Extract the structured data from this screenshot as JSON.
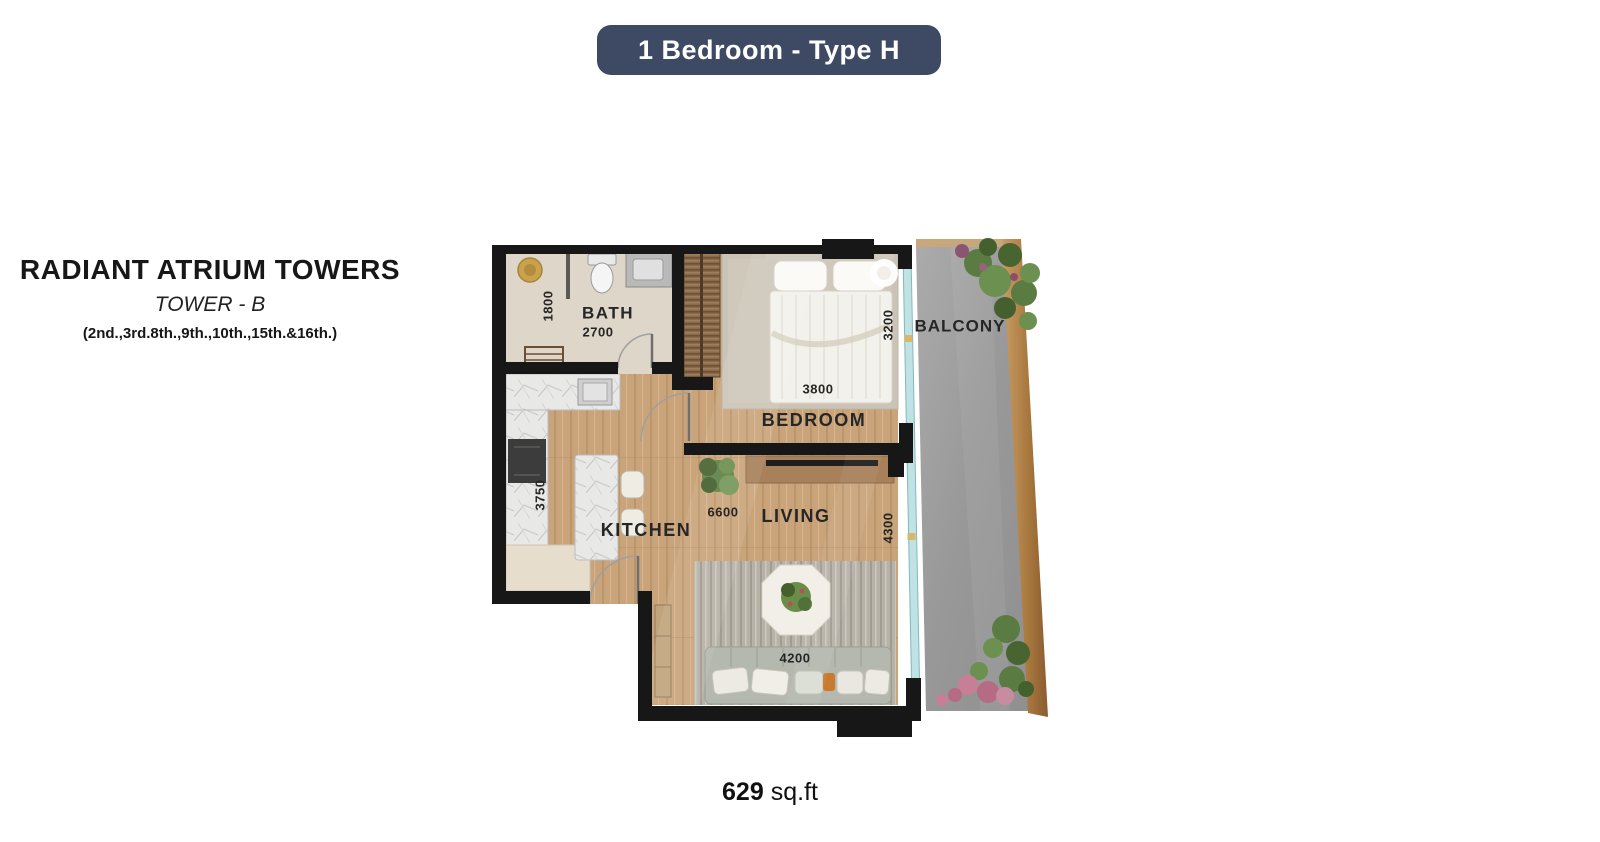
{
  "badge": {
    "label": "1 Bedroom - Type H"
  },
  "project": {
    "title": "RADIANT ATRIUM TOWERS",
    "tower": "TOWER - B",
    "floors": "(2nd.,3rd.8th.,9th.,10th.,15th.&16th.)"
  },
  "plan": {
    "bath": {
      "label": "BATH",
      "width": "2700",
      "depth": "1800"
    },
    "bedroom": {
      "label": "BEDROOM",
      "width": "3800",
      "depth": "3200"
    },
    "kitchen": {
      "label": "KITCHEN",
      "depth": "3750"
    },
    "living": {
      "label": "LIVING",
      "width": "6600",
      "depth": "4300",
      "sofa_width": "4200"
    },
    "balcony": {
      "label": "BALCONY"
    }
  },
  "area": {
    "value": "629",
    "unit": "sq.ft"
  },
  "colors": {
    "badge_bg": "#3E4A63",
    "badge_text": "#FFFFFF",
    "wall": "#171717",
    "wood_floor": "#C8A177",
    "bath_floor": "#DED6C8",
    "carpet": "#CBC4B6",
    "balcony_floor": "#9C9C9C",
    "bronze_trim": "#B5854F",
    "glass": "#BFE2E4"
  }
}
